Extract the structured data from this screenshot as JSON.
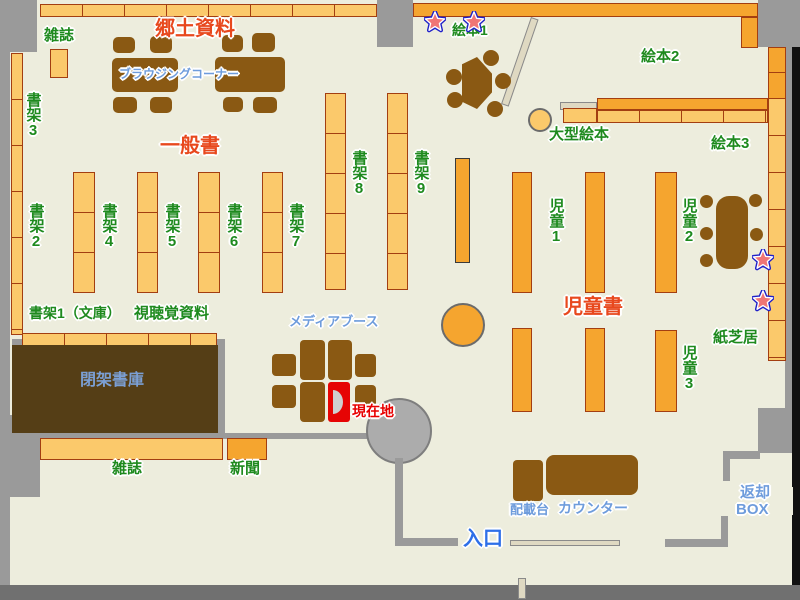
{
  "colors": {
    "floor": "#EDEDDD",
    "wall_gray": "#9A9A9A",
    "shelf_light": "#FBC96B",
    "shelf_dark": "#F5A52F",
    "shelf_border": "#A33E11",
    "furniture_brown": "#8A5913",
    "closed_stack_brown": "#553E16",
    "label_green": "#1E8A1E",
    "label_red_orange": "#E8481D",
    "label_blue": "#6E9CDC",
    "entrance_blue": "#2E6FE8",
    "current_location_red": "#E80000",
    "star_fill": "#F07575",
    "star_outline": "#1F1FC8"
  },
  "sections": {
    "kyodo_shiryo": "郷土資料",
    "ippansho": "一般書",
    "jidosho": "児童書"
  },
  "shelves": {
    "zasshi_top": "雑誌",
    "shoka1_bunko": "書架1（文庫）",
    "shoka2": "書架2",
    "shoka3": "書架3",
    "shoka4": "書架4",
    "shoka5": "書架5",
    "shoka6": "書架6",
    "shoka7": "書架7",
    "shoka8": "書架8",
    "shoka9": "書架9",
    "shichokaku": "視聴覚資料",
    "zasshi_bottom": "雑誌",
    "shinbun": "新聞",
    "ehon1": "絵本1",
    "ehon2": "絵本2",
    "ehon3": "絵本3",
    "ogata_ehon": "大型絵本",
    "jido1": "児童1",
    "jido2": "児童2",
    "jido3": "児童3",
    "kamishibai": "紙芝居"
  },
  "facilities": {
    "browsing_corner": "ブラウジングコーナー",
    "media_booth": "メディアブース",
    "current_location": "現在地",
    "heika_shoko": "閉架書庫",
    "counter": "カウンター",
    "haisaidai": "配載台",
    "entrance": "入口",
    "return_box_line1": "返却",
    "return_box_line2": "BOX"
  }
}
